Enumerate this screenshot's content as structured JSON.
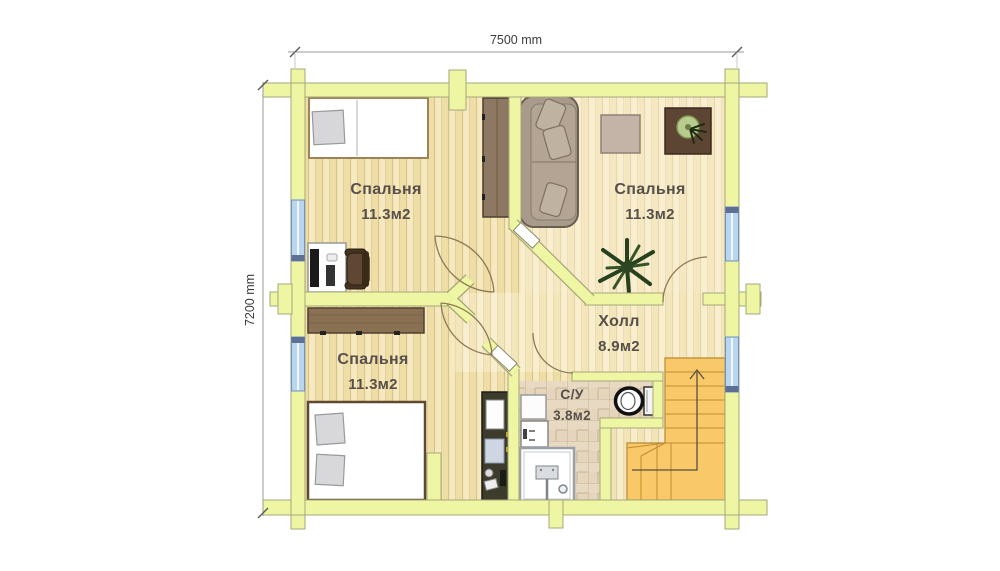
{
  "type": "floor-plan",
  "floor": {
    "dimensions": {
      "width_label": "7500 mm",
      "height_label": "7200 mm"
    },
    "rooms": [
      {
        "name": "Спальня",
        "area": "11.3м2",
        "position": "top-left"
      },
      {
        "name": "Спальня",
        "area": "11.3м2",
        "position": "top-right"
      },
      {
        "name": "Спальня",
        "area": "11.3м2",
        "position": "bottom-left"
      },
      {
        "name": "Холл",
        "area": "8.9м2",
        "position": "center-right"
      },
      {
        "name": "С/У",
        "area": "3.8м2",
        "position": "bottom-center"
      }
    ],
    "features": [
      "staircase-up",
      "4-windows",
      "log-wall-ends"
    ],
    "furniture": [
      "single-bed",
      "double-bed",
      "pillow",
      "wardrobe",
      "computer-desk",
      "office-chair",
      "corner-sofa",
      "coffee-table",
      "plant-table",
      "potted-plant",
      "floor-plant",
      "shelf",
      "dark-cabinet",
      "washbasin",
      "bath-cabinet",
      "shower-cabin",
      "toilet"
    ],
    "colors": {
      "wall": "#eef6a3",
      "wall_outline": "#a6a77b",
      "floor_plank": "#f3e3b2",
      "plank_line": "#d8c28c",
      "tile": "#e4d5bc",
      "tile_grout": "#c7b295",
      "stairs": "#f9c869",
      "stairs_line": "#c08c35",
      "window": "#b9d6f1",
      "label_text": "#57504a",
      "dimension_text": "#3c3c3c"
    }
  }
}
